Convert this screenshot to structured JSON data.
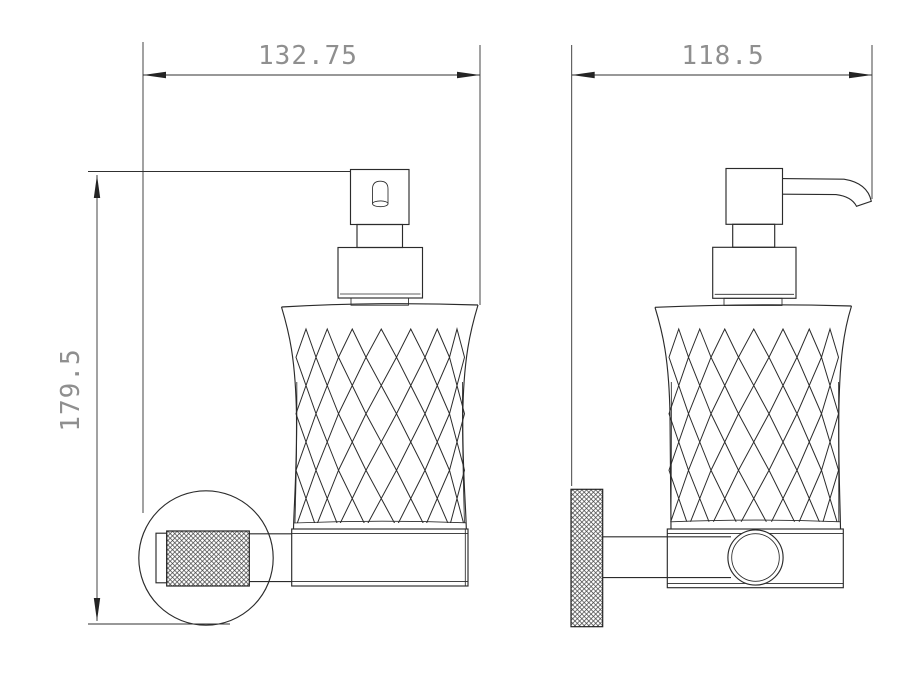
{
  "dimensions": {
    "left_view_width": "132.75",
    "left_view_height": "179.5",
    "right_view_width": "118.5"
  },
  "colors": {
    "line": "#2b2b2b",
    "dimension_text": "#8f8f8f",
    "background": "#ffffff"
  }
}
